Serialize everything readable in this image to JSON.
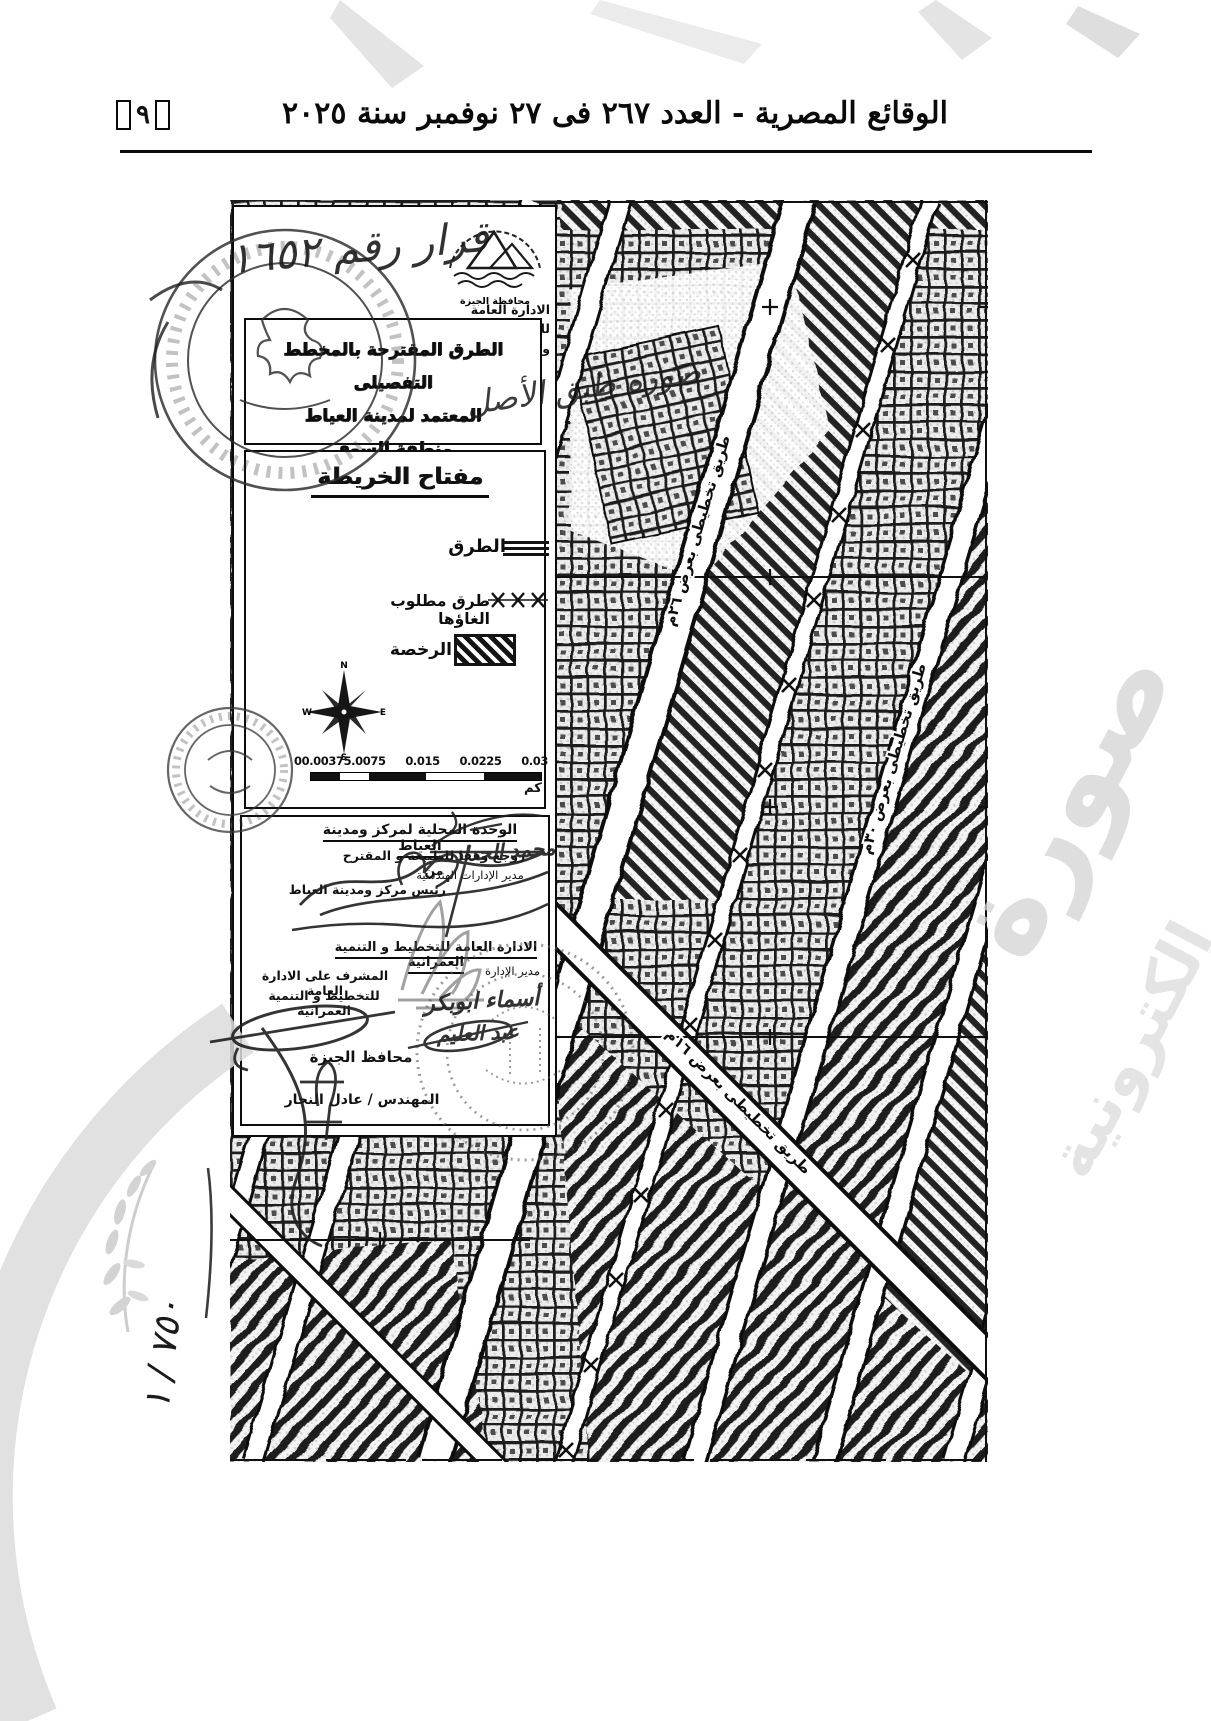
{
  "header": {
    "title": "الوقائع المصرية - العدد ٢٦٧ فى ٢٧ نوفمبر سنة ٢٠٢٥",
    "page_number": "٩"
  },
  "doc": {
    "agency": {
      "logo_caption": "محافظة الجيزة",
      "dept_line1": "الادارة العامة للتخطيط",
      "dept_line2": "والتنمية العمرانية"
    },
    "notes": {
      "decision": "قرار رقم ١٦٥٢",
      "copy": "صورة طبق الأصل",
      "ratio": "٧٥٠ / ١"
    },
    "title_box": {
      "line1": "الطرق المقترحة بالمخطط التفصيلى",
      "line2": "المعتمد لمدينة العياط",
      "line3": "منطقة السوق"
    },
    "key": {
      "title": "مفتاح الخريطة",
      "roads_label": "الطرق",
      "cancelled_label": "طرق مطلوب الغاؤها",
      "license_label": "الرخصة",
      "compass": {
        "n": "N",
        "e": "E",
        "s": "S",
        "w": "W"
      },
      "scale": {
        "labels": [
          "00.00375.0075",
          "0.015",
          "0.0225",
          "0.03"
        ],
        "unit": "كم"
      }
    },
    "sig": {
      "local_unit": "الوحدة المحلية لمركز ومدينة العياط",
      "reviewed": "روجع وفقا للطبيعة و المقترح من",
      "eng_dir_title": "مدير الإدارات الهندسية",
      "eng_dir_name": "محمد الحداد",
      "head_title": "رئيس مركز ومدينة العياط",
      "planning_title": "الادارة العامة للتخطيط و التنمية العمرانية",
      "sup1": "المشرف على الادارة العامة",
      "sup2": "للتخطيط و التنمية العمرانية",
      "admin_dir_title": "مدير الإدارة",
      "admin_name1": "أسماء ابوبكر",
      "admin_name2": "عبد العليم",
      "governor_title": "محافظ الجيزة",
      "governor_name": "المهندس / عادل النجار"
    },
    "map": {
      "label1": "طريق تخطيطى بعرض ٢٦م",
      "label2": "طريق تخطيطى بعرض ٣٠م",
      "label3": "طريق تخطيطى بعرض ١٦م"
    }
  },
  "watermark": {
    "fragment1": "صورة",
    "fragment2": "إلكترونية"
  }
}
